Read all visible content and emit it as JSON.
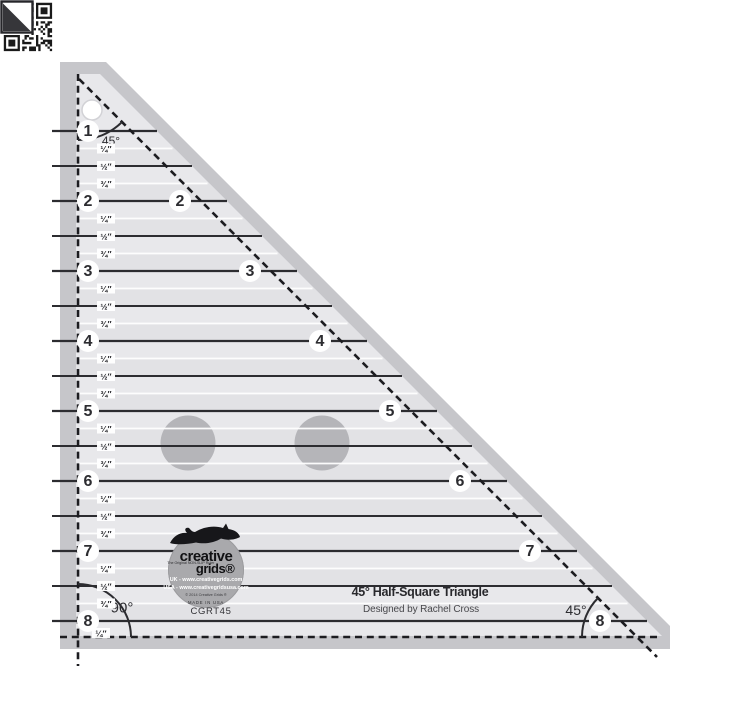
{
  "product": {
    "name": "45° Half-Square Triangle",
    "designer": "Designed by Rachel Cross",
    "model": "CGRT45"
  },
  "brand": {
    "name_top": "creative",
    "name_bottom": "grids®",
    "tagline": "The Original NON-SLIP Ruler",
    "uk": "UK - www.creativegrids.com",
    "usa": "USA - www.creativegridsusa.com",
    "copyright": "© 2014 Creative Grids ®",
    "made_in": "MADE IN USA"
  },
  "angle_labels": {
    "apex": "45°",
    "bottom_left": "90°",
    "bottom_right": "45°"
  },
  "scale": {
    "left_numbers": [
      1,
      2,
      3,
      4,
      5,
      6,
      7,
      8
    ],
    "hypotenuse_numbers": [
      2,
      3,
      4,
      5,
      6,
      7,
      8
    ],
    "fraction_labels": [
      "¼″",
      "½″",
      "¾″"
    ],
    "trailing_fraction": "¼″"
  },
  "colors": {
    "edge_band": "#c6c6ca",
    "surface": "#e8e8eb",
    "surface_alt": "#e2e2e5",
    "line_dark": "#2c2c30",
    "line_white": "#ffffff",
    "dash": "#1c1c20",
    "grip": "#b5b5b9",
    "logo_circle": "#a9a9ac",
    "qr_dark": "#1a1a1a"
  }
}
